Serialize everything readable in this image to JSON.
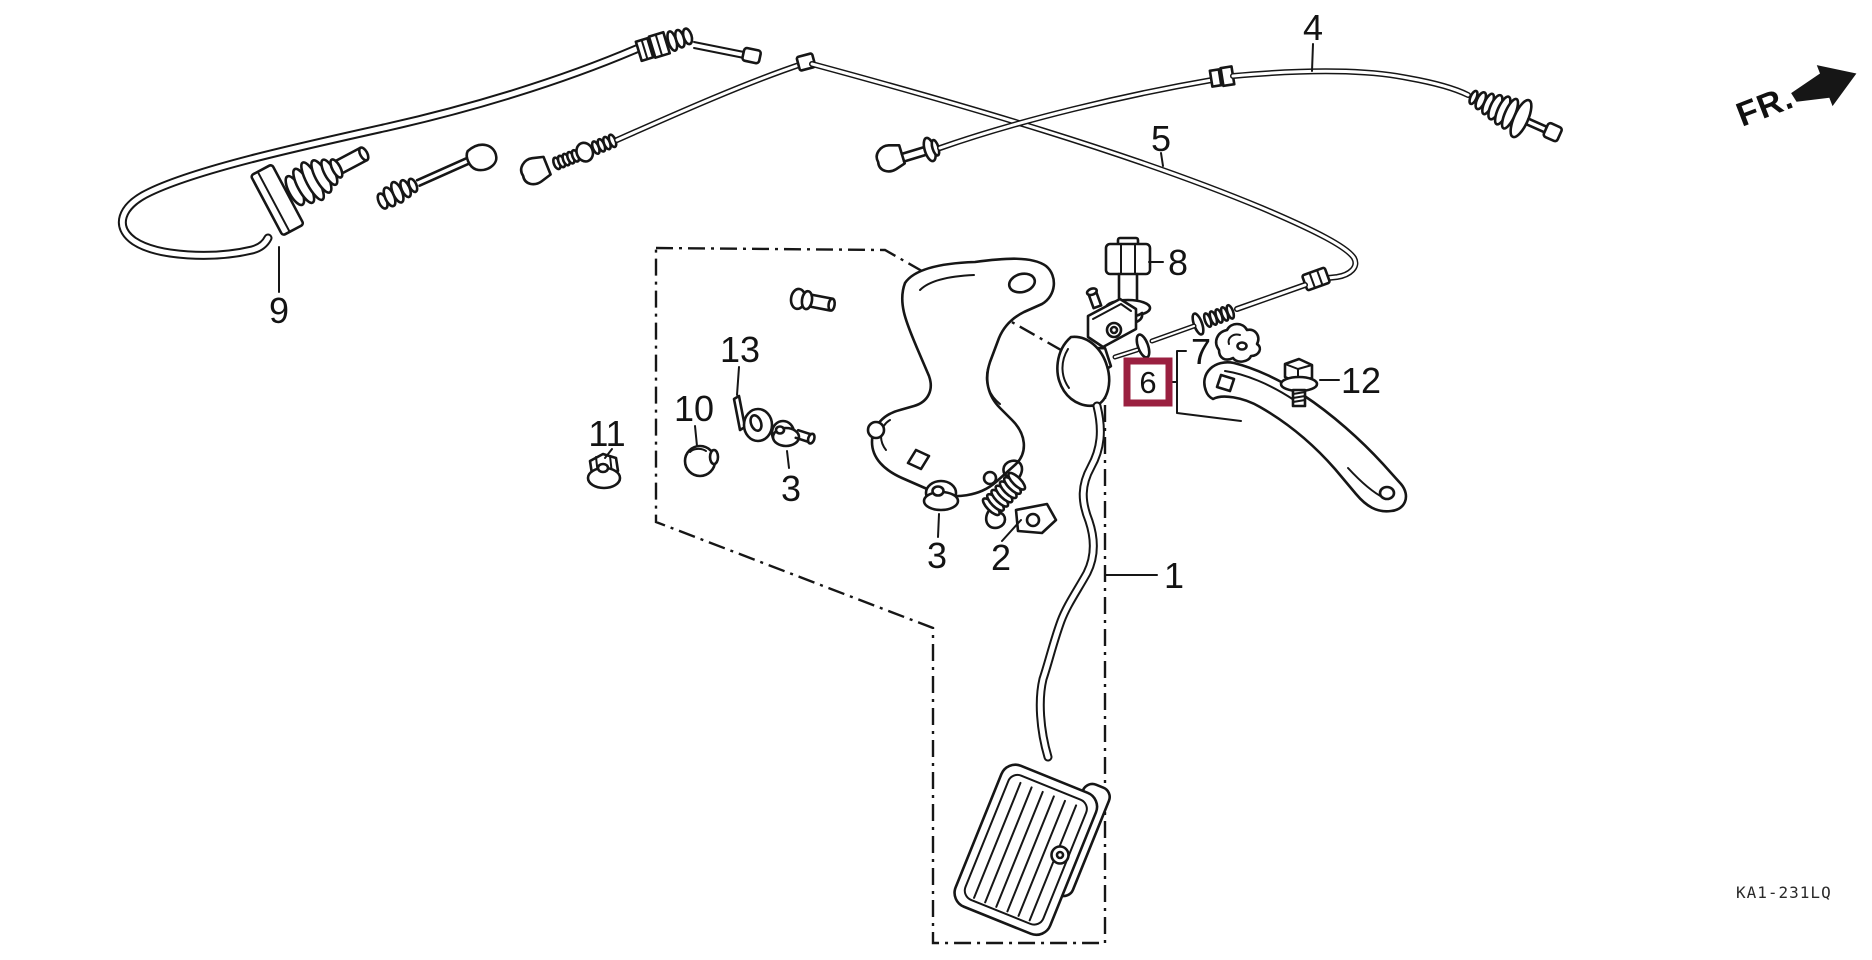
{
  "diagram": {
    "fr_indicator": "FR.",
    "code": "KA1-231LQ",
    "highlighted_callout": "6",
    "colors": {
      "line": "#161616",
      "background": "#ffffff",
      "highlight": "#9a2040"
    },
    "callouts": {
      "c1": "1",
      "c2": "2",
      "c3a": "3",
      "c3b": "3",
      "c4": "4",
      "c5": "5",
      "c6": "6",
      "c7": "7",
      "c8": "8",
      "c9": "9",
      "c10": "10",
      "c11": "11",
      "c12": "12",
      "c13": "13"
    }
  }
}
